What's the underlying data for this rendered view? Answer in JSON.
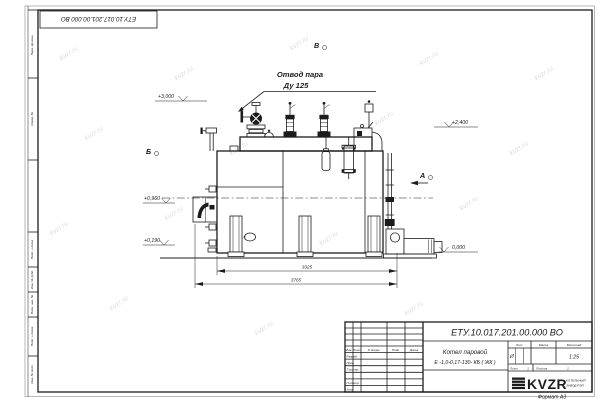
{
  "page": {
    "watermark": "kvzr.ru",
    "format_note": "Формат А3"
  },
  "margin": {
    "top_stamp": "ЕТУ.10.017.201.00.000  ВО",
    "label_perv": "Перв. примен.",
    "label_sprav": "Справ. №",
    "label_podp1": "Подп. и дата",
    "label_dubl": "Инв. № дубл.",
    "label_vzam": "Взам. инв. №",
    "label_podp2": "Подп. и дата",
    "label_podl": "Инв. № подл."
  },
  "drawing": {
    "callout_line1": "Отвод пара",
    "callout_line2": "Ду 125",
    "view_top": "В",
    "view_left": "Б",
    "view_right": "А",
    "elev_3000": "+3,000",
    "elev_2400": "+2,400",
    "elev_0960": "+0,960",
    "elev_0190": "+0,190",
    "elev_0000": "0,000",
    "dim_inner": "3325",
    "dim_outer": "3765"
  },
  "title_block": {
    "doc_number": "ЕТУ.10.017.201.00.000  ВО",
    "product_line1": "Котел паровой",
    "product_line2": "Е -1,0-0,17-130- КБ ( ЖК )",
    "col_izm": "Изм.",
    "col_list": "Лист",
    "col_doc": "N докум.",
    "col_sign": "Подп.",
    "col_date": "Дата",
    "row_razrab": "Разраб.",
    "row_prov": "Пров.",
    "row_tkontr": "Т.контр.",
    "row_nkontr": "Н.контр.",
    "row_utv": "Утв.",
    "lit_label": "Лит.",
    "lit_value": "И",
    "mass_label": "Масса",
    "scale_label": "Масштаб",
    "scale_value": "1:25",
    "sheet_label": "Лист",
    "sheet_value": "1",
    "sheets_label": "Листов",
    "sheets_value": "2",
    "logo_text": "KVZR",
    "logo_sub1": "КОТЕЛЬНЫЙ",
    "logo_sub2": "ЗАВОД РЭП"
  }
}
